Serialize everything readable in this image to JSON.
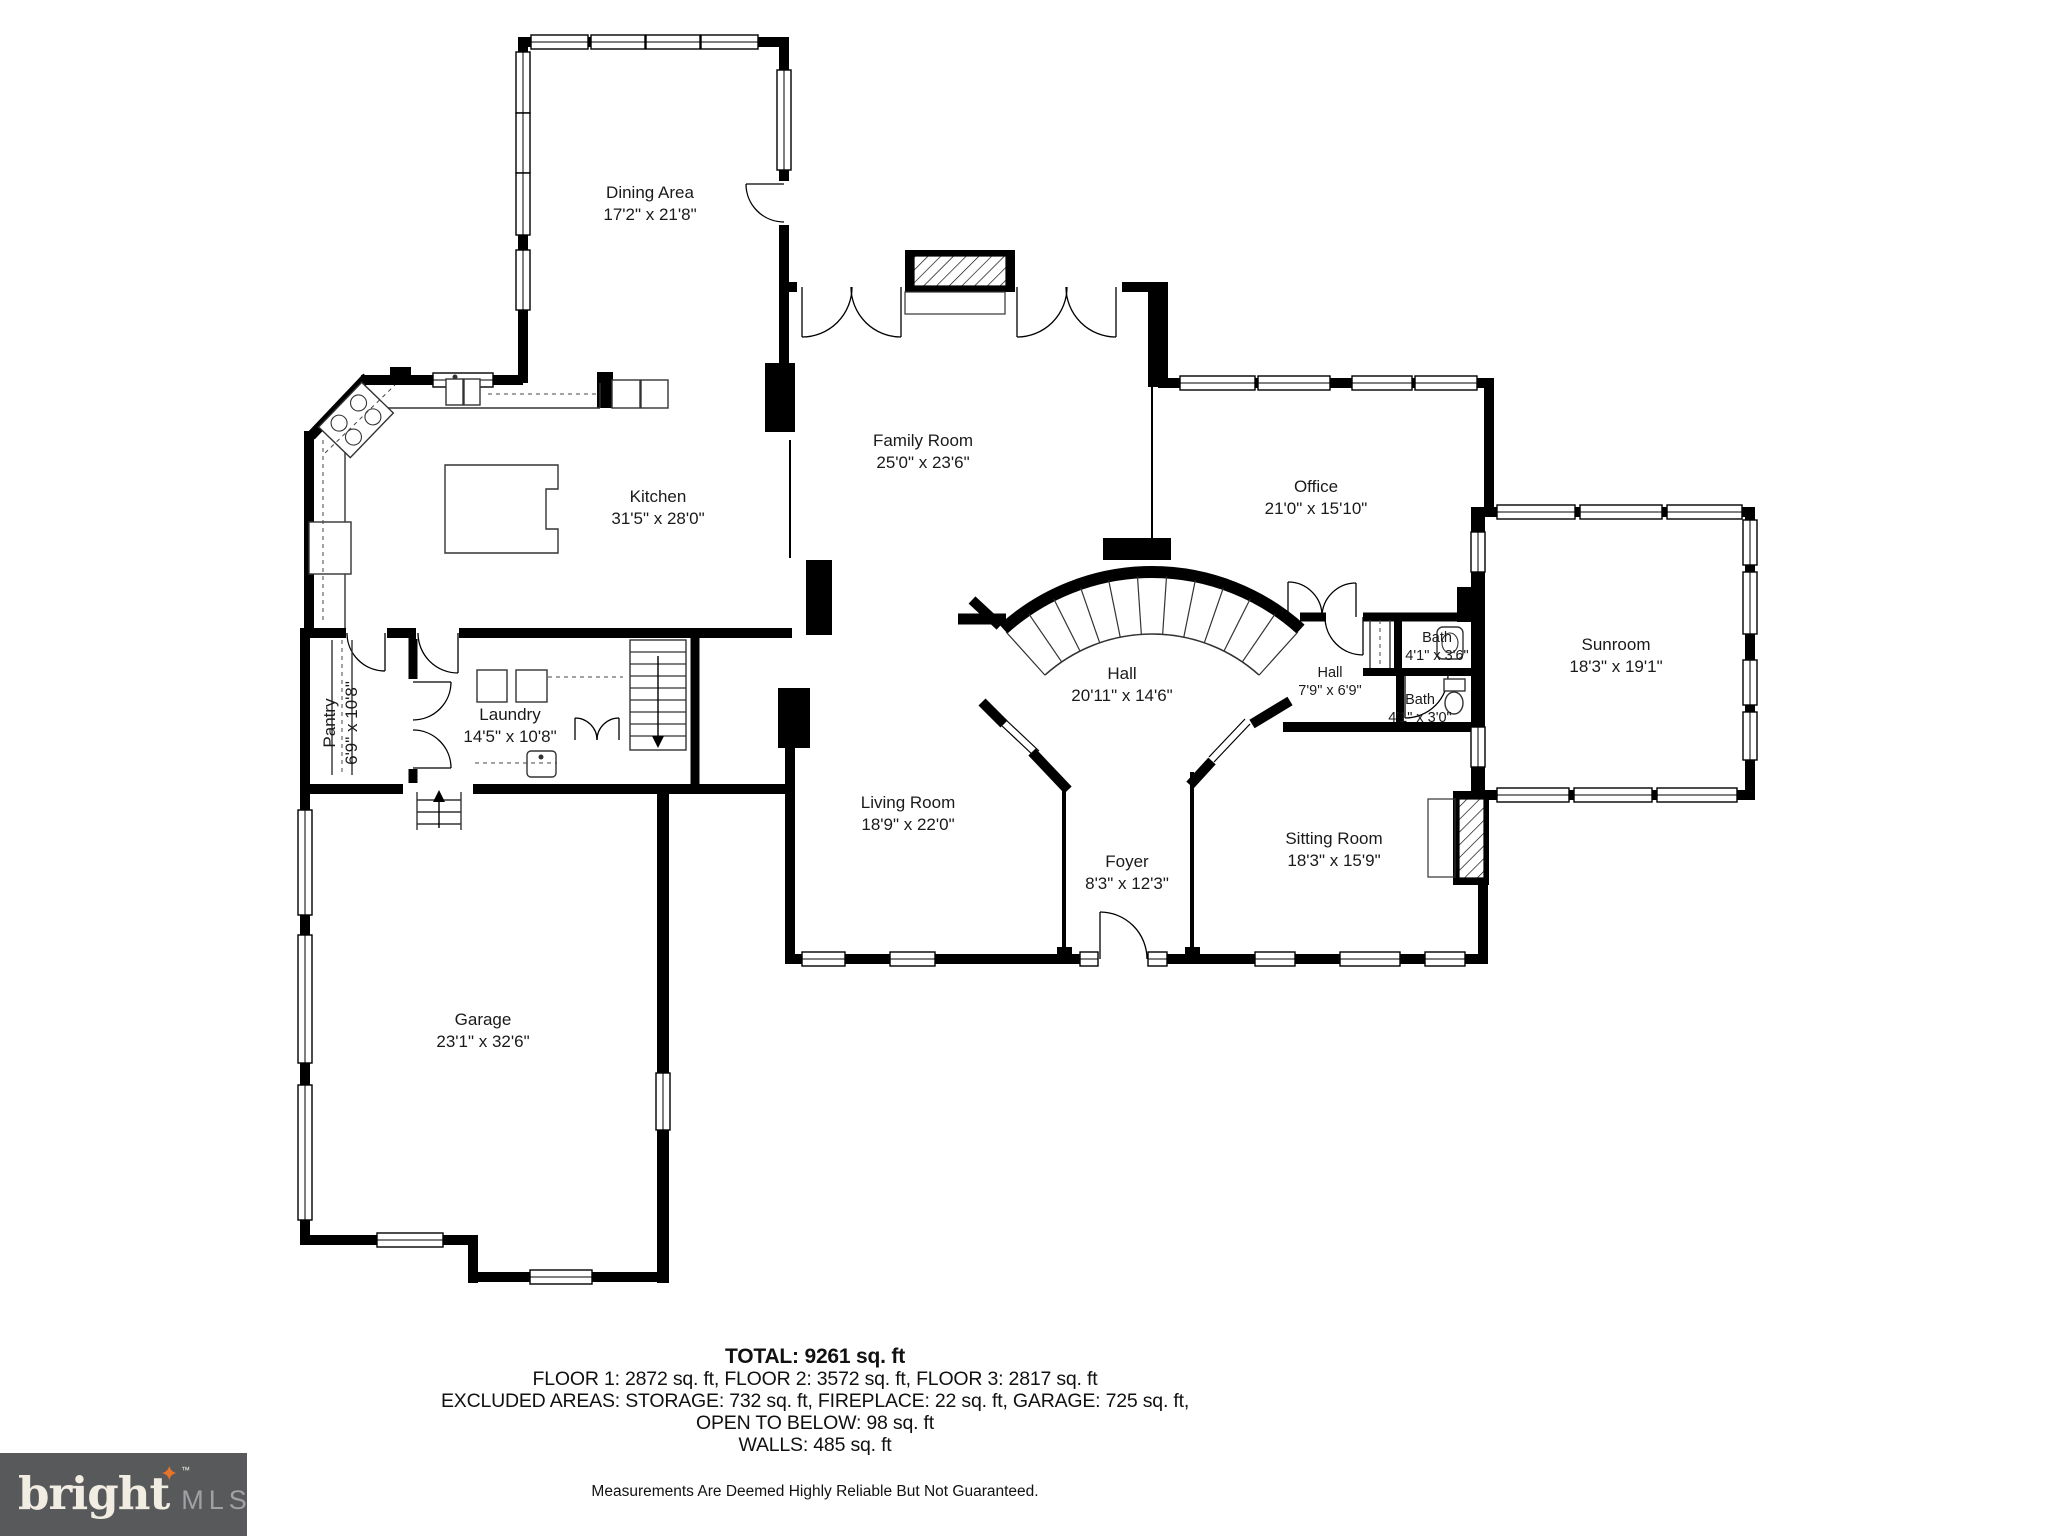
{
  "floorplan": {
    "rooms": [
      {
        "id": "dining-area",
        "name": "Dining Area",
        "dims": "17'2\" x 21'8\""
      },
      {
        "id": "family-room",
        "name": "Family Room",
        "dims": "25'0\" x 23'6\""
      },
      {
        "id": "kitchen",
        "name": "Kitchen",
        "dims": "31'5\" x 28'0\""
      },
      {
        "id": "office",
        "name": "Office",
        "dims": "21'0\" x 15'10\""
      },
      {
        "id": "hall-main",
        "name": "Hall",
        "dims": "20'11\" x 14'6\""
      },
      {
        "id": "pantry",
        "name": "Pantry",
        "dims": "6'9\" x 10'8\""
      },
      {
        "id": "laundry",
        "name": "Laundry",
        "dims": "14'5\" x 10'8\""
      },
      {
        "id": "bath-upper",
        "name": "Bath",
        "dims": "4'1\" x 3'6\""
      },
      {
        "id": "hall-small",
        "name": "Hall",
        "dims": "7'9\" x 6'9\""
      },
      {
        "id": "bath-lower",
        "name": "Bath",
        "dims": "4'1\" x 3'0\""
      },
      {
        "id": "sunroom",
        "name": "Sunroom",
        "dims": "18'3\" x 19'1\""
      },
      {
        "id": "living-room",
        "name": "Living Room",
        "dims": "18'9\" x 22'0\""
      },
      {
        "id": "foyer",
        "name": "Foyer",
        "dims": "8'3\" x 12'3\""
      },
      {
        "id": "sitting-room",
        "name": "Sitting Room",
        "dims": "18'3\" x 15'9\""
      },
      {
        "id": "garage",
        "name": "Garage",
        "dims": "23'1\" x 32'6\""
      }
    ],
    "summary": {
      "total": "TOTAL: 9261 sq. ft",
      "floors": "FLOOR 1: 2872 sq. ft, FLOOR 2: 3572 sq. ft, FLOOR 3: 2817 sq. ft",
      "excluded": "EXCLUDED AREAS: STORAGE: 732 sq. ft, FIREPLACE: 22 sq. ft, GARAGE: 725 sq. ft,",
      "open_below": "OPEN TO BELOW: 98 sq. ft",
      "walls": "WALLS: 485 sq. ft"
    },
    "disclaimer": "Measurements Are Deemed Highly Reliable But Not Guaranteed.",
    "logo": {
      "brand": "bright",
      "tm": "TM",
      "suffix": "MLS"
    },
    "colors": {
      "wall": "#000000",
      "star_accent": "#e8732a",
      "logo_bg": "#58595b"
    }
  }
}
